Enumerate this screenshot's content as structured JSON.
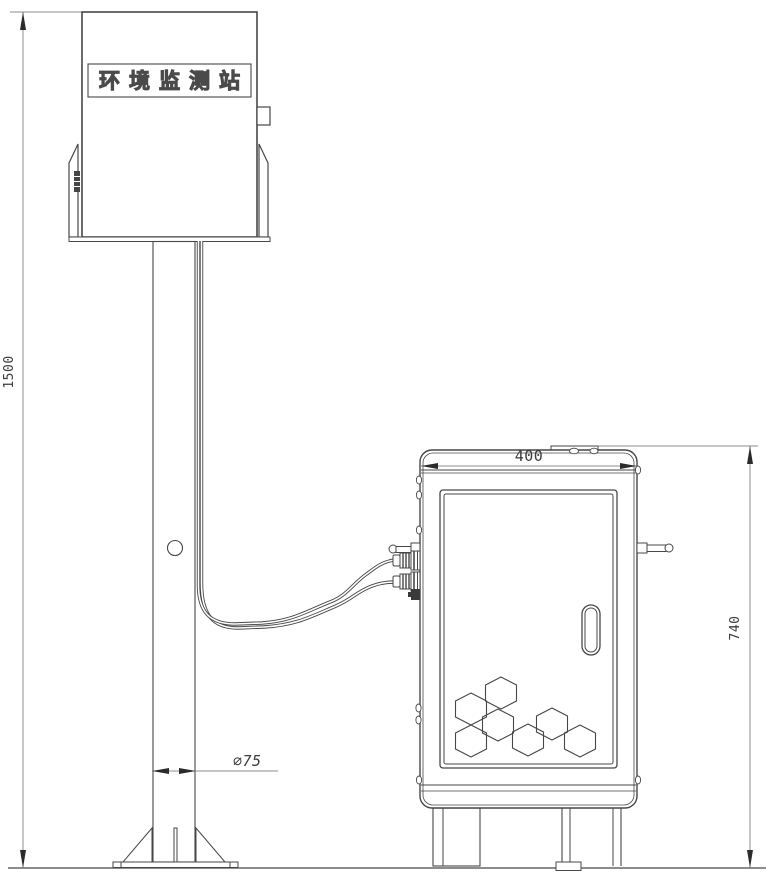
{
  "drawing": {
    "station_label": "环境监测站",
    "dimensions": {
      "pole_height": "1500",
      "pole_diameter": "∅75",
      "cabinet_width": "400",
      "cabinet_height": "740"
    },
    "colors": {
      "line": "#474747",
      "dimension_line": "#8c8c8c",
      "arrow": "#2b2b2b",
      "background": "#ffffff"
    },
    "icons": {
      "hex_pattern": "honeycomb-vent-decoration",
      "door_handle": "oval-recessed-handle",
      "cable_glands": "threaded-cable-glands",
      "antenna_rod": "side-antenna-rod"
    }
  }
}
